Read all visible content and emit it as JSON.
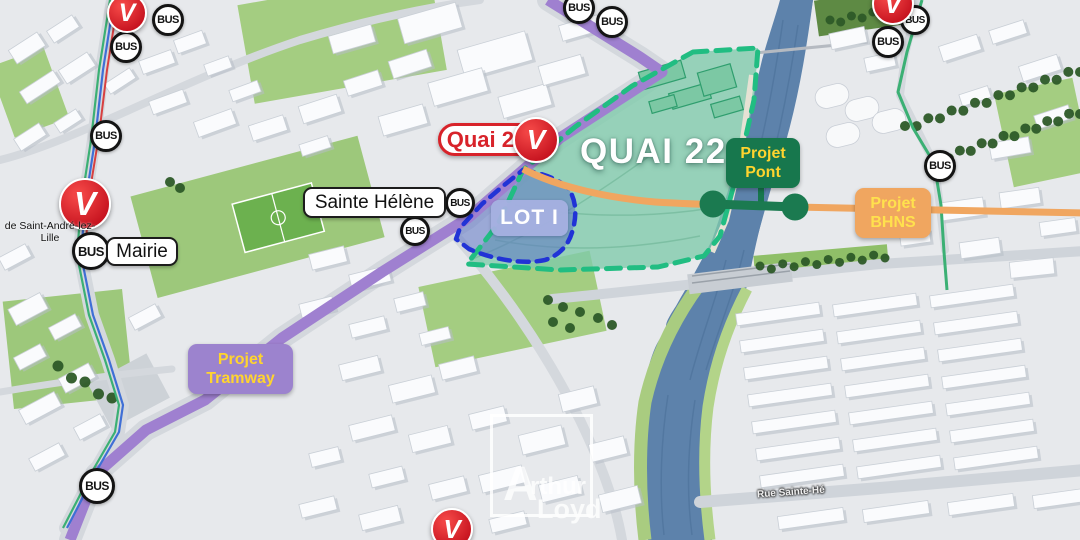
{
  "zone": {
    "title": "QUAI 22",
    "lot_label": "LOT I"
  },
  "station_label": {
    "name": "Quai 22"
  },
  "projects": {
    "pont": {
      "line1": "Projet",
      "line2": "Pont"
    },
    "bhns": {
      "line1": "Projet",
      "line2": "BHNS"
    },
    "tramway": {
      "line1": "Projet",
      "line2": "Tramway"
    }
  },
  "places": {
    "sainte_helene": "Sainte Hélène",
    "mairie": "Mairie",
    "saint_andre_line1": "de Saint-André-lez-",
    "saint_andre_line2": "Lille",
    "street": "Rue Sainte-Hé"
  },
  "transit": {
    "bus_label": "BUS",
    "v_letter": "V",
    "bus_stops": [
      {
        "x": 168,
        "y": 20,
        "r": 16
      },
      {
        "x": 126,
        "y": 47,
        "r": 16
      },
      {
        "x": 106,
        "y": 136,
        "r": 16
      },
      {
        "x": 579,
        "y": 8,
        "r": 16
      },
      {
        "x": 612,
        "y": 22,
        "r": 16
      },
      {
        "x": 460,
        "y": 203,
        "r": 15
      },
      {
        "x": 415,
        "y": 231,
        "r": 15
      },
      {
        "x": 91,
        "y": 251,
        "r": 19
      },
      {
        "x": 97,
        "y": 486,
        "r": 18
      },
      {
        "x": 915,
        "y": 20,
        "r": 15
      },
      {
        "x": 888,
        "y": 42,
        "r": 16
      },
      {
        "x": 940,
        "y": 166,
        "r": 16
      }
    ],
    "v_stations": [
      {
        "x": 127,
        "y": 13,
        "r": 20
      },
      {
        "x": 85,
        "y": 204,
        "r": 26
      },
      {
        "x": 893,
        "y": 4,
        "r": 21
      },
      {
        "x": 452,
        "y": 529,
        "r": 21
      }
    ]
  },
  "watermark": {
    "big": "A",
    "rest": "rthur",
    "second": "Loyd"
  },
  "colors": {
    "zone_fill": "#7fcbab",
    "zone_border": "#21bd82",
    "lot_fill": "#5c74c4",
    "lot_border": "#2133d6",
    "lot_badge": "#a5b0e0",
    "tram": "#9f80d0",
    "bhns": "#f0a660",
    "pont_green": "#17774d",
    "badge_yellow": "#ffd42e",
    "bhns_text": "#ffe14d",
    "tramway_purple": "#9c83ce",
    "river": "#5d82ab",
    "v_red": "#d8232a"
  }
}
